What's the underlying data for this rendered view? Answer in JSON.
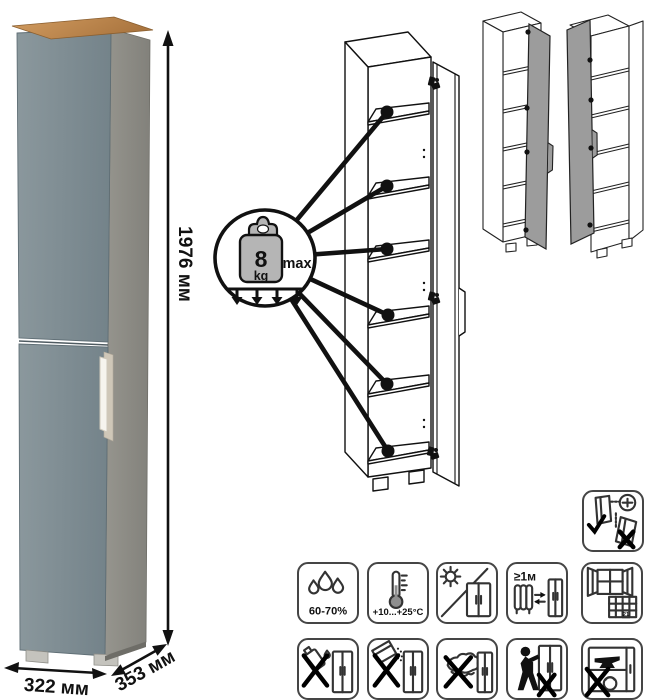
{
  "dimensions": {
    "height": "1976 мм",
    "width": "322 мм",
    "depth": "353 мм"
  },
  "shelf_load": {
    "value": "8",
    "unit": "kg",
    "qualifier": "max"
  },
  "care": {
    "humidity": "60-70%",
    "temperature": "+10...+25°С",
    "heat_distance": "≥1м",
    "calendar_day": "21"
  },
  "icons": [
    {
      "name": "humidity-range",
      "label": "60-70%"
    },
    {
      "name": "temperature-range",
      "label": "+10...+25°С"
    },
    {
      "name": "avoid-direct-sunlight",
      "label": ""
    },
    {
      "name": "keep-distance-from-heat",
      "label": "≥1м"
    },
    {
      "name": "ventilate-acclimatize",
      "label": "21"
    },
    {
      "name": "no-aggressive-liquids",
      "label": ""
    },
    {
      "name": "no-abrasive-cleaners",
      "label": ""
    },
    {
      "name": "no-wet-cloth",
      "label": ""
    },
    {
      "name": "do-not-drag",
      "label": ""
    },
    {
      "name": "no-heavy-objects",
      "label": ""
    },
    {
      "name": "secure-to-wall",
      "label": ""
    }
  ],
  "colors": {
    "door": "#7f8d93",
    "side": "#8c8b85",
    "wood_top": "#bf8950",
    "handle": "#f6f4ee",
    "line": "#111111",
    "variant_door": "#9c9c9c"
  }
}
